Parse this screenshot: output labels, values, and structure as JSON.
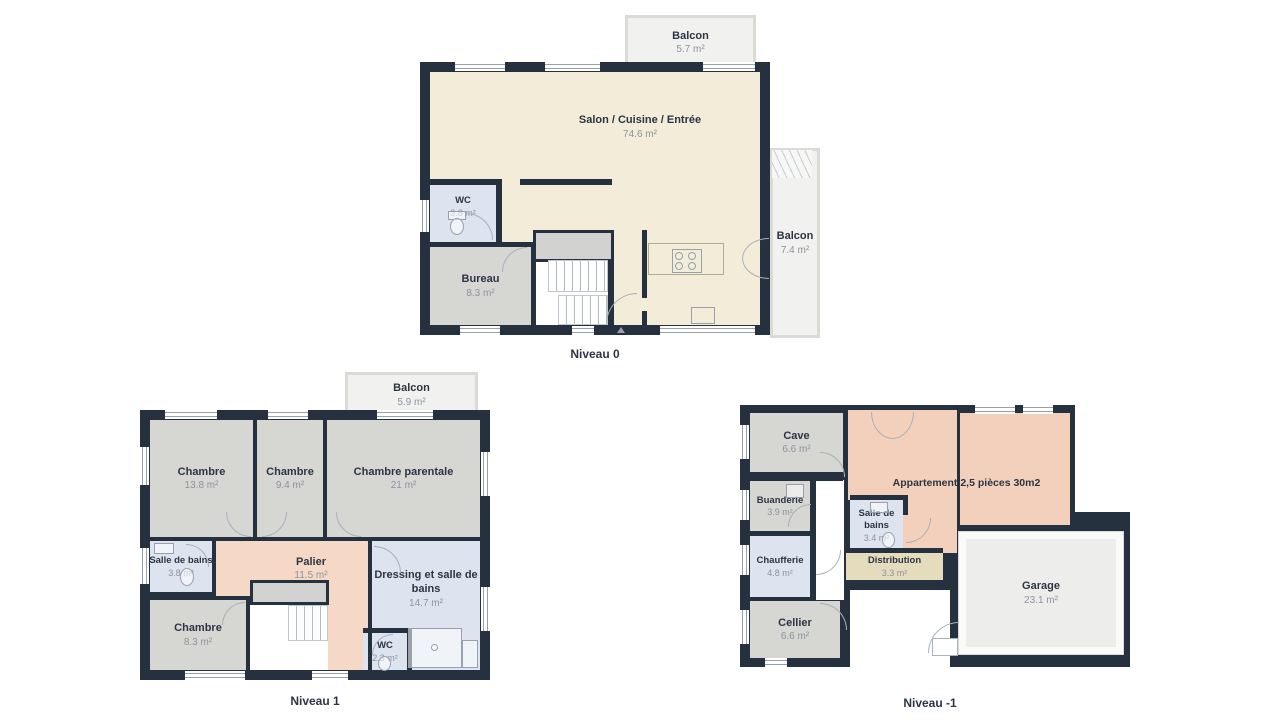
{
  "palette": {
    "wall": "#25313f",
    "living_floor": "#f2ecd8",
    "bedroom_floor": "#d6d6d3",
    "bathroom_floor": "#dde4ef",
    "hall_floor": "#f5d9c6",
    "apartment_floor": "#f3d0bc",
    "distribution_floor": "#e5dcbe",
    "balcony_floor": "#f1f1ef",
    "garage_floor": "#ededec"
  },
  "levels": {
    "level0": {
      "label": "Niveau 0",
      "balcony_top": {
        "name": "Balcon",
        "area": "5.7 m²"
      },
      "salon": {
        "name": "Salon / Cuisine / Entrée",
        "area": "74.6 m²"
      },
      "wc": {
        "name": "WC",
        "area": "3.8 m²"
      },
      "bureau": {
        "name": "Bureau",
        "area": "8.3 m²"
      },
      "balcony_right": {
        "name": "Balcon",
        "area": "7.4 m²"
      }
    },
    "level1": {
      "label": "Niveau 1",
      "balcony": {
        "name": "Balcon",
        "area": "5.9 m²"
      },
      "chambre1": {
        "name": "Chambre",
        "area": "13.8 m²"
      },
      "chambre2": {
        "name": "Chambre",
        "area": "9.4 m²"
      },
      "chambre_parentale": {
        "name": "Chambre parentale",
        "area": "21 m²"
      },
      "salle_de_bains": {
        "name": "Salle de bains",
        "area": "3.8 m²"
      },
      "palier": {
        "name": "Palier",
        "area": "11.5 m²"
      },
      "dressing": {
        "name": "Dressing et salle de bains",
        "area": "14.7 m²"
      },
      "chambre3": {
        "name": "Chambre",
        "area": "8.3 m²"
      },
      "wc": {
        "name": "WC",
        "area": "2.3 m²"
      }
    },
    "levelm1": {
      "label": "Niveau -1",
      "cave": {
        "name": "Cave",
        "area": "6.6 m²"
      },
      "buanderie": {
        "name": "Buanderie",
        "area": "3.9 m²"
      },
      "chaufferie": {
        "name": "Chaufferie",
        "area": "4.8 m²"
      },
      "cellier": {
        "name": "Cellier",
        "area": "6.6 m²"
      },
      "salle_de_bains": {
        "name": "Salle de bains",
        "area": "3.4 m²"
      },
      "appartement": {
        "name": "Appartement 2,5 pièces 30m2"
      },
      "distribution": {
        "name": "Distribution",
        "area": "3.3 m²"
      },
      "garage": {
        "name": "Garage",
        "area": "23.1 m²"
      }
    }
  }
}
